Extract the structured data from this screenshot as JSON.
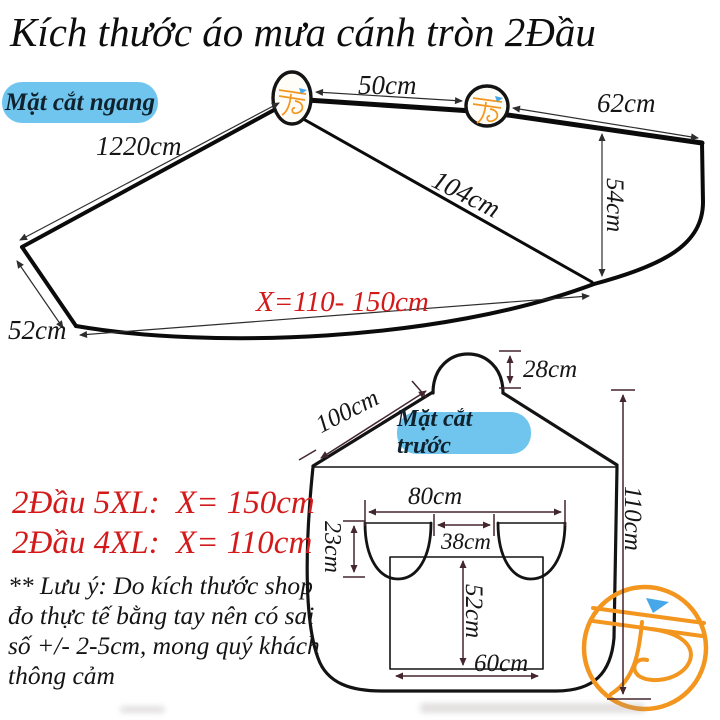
{
  "title": "Kích thước áo mưa cánh tròn 2Đầu",
  "colors": {
    "badge_bg": "#6fc5ee",
    "badge_text": "#10222e",
    "accent_red": "#d31a1a",
    "outline_black": "#0b0b0b",
    "dim_dark": "#2e2e2e",
    "dim_maroon": "#44262f",
    "logo_orange": "#f3961f",
    "logo_blue": "#47a7e8"
  },
  "top_view": {
    "badge": "Mặt cắt ngang",
    "labels": {
      "between_mirrors": "50cm",
      "top_right_edge": "62cm",
      "left_edge": "1220cm",
      "diagonal": "104cm",
      "right_height": "54cm",
      "bottom_length": "X=110- 150cm",
      "lower_left_edge": "52cm"
    }
  },
  "front_view": {
    "badge": "Mặt cắt trước",
    "labels": {
      "hood_height": "28cm",
      "shoulder_slope": "100cm",
      "mirrors_span": "80cm",
      "mirrors_gap": "38cm",
      "mirror_depth": "23cm",
      "body_height": "110cm",
      "window_height": "52cm",
      "window_width": "60cm"
    }
  },
  "size_options": [
    "2Đầu 5XL:  X= 150cm",
    "2Đầu 4XL:  X= 110cm"
  ],
  "note": "** Lưu ý: Do kích thước shop đo thực tế bằng tay nên có sai số +/- 2-5cm, mong quý khách thông cảm",
  "logo": {
    "name": "TS"
  }
}
